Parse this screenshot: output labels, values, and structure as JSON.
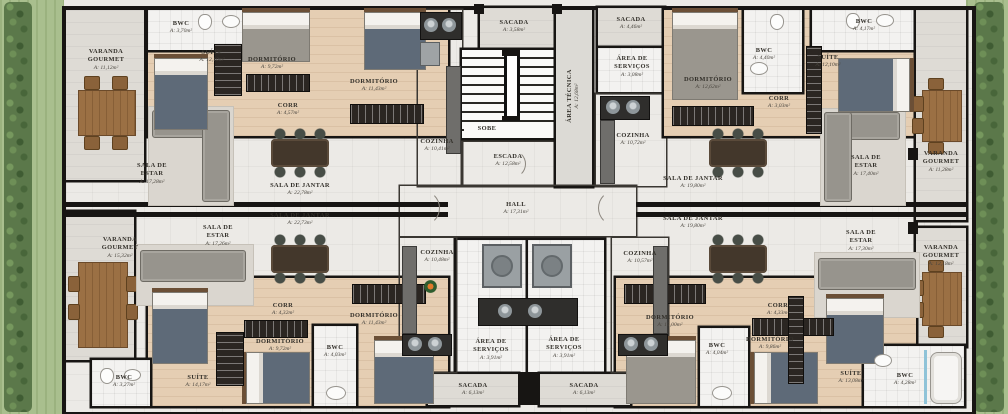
{
  "palette": {
    "wall": "#171513",
    "wood_floor": "#e5ceb3",
    "tile_floor": "#eceae6",
    "balcony_floor": "#dedbd5",
    "grass": "#a9bf8e",
    "hedge": "#5b784a",
    "table_wood": "#9b7044",
    "sofa": "#97948d",
    "blanket": "#5e6a78"
  },
  "labels": {
    "tl_bwc": {
      "name": "BWC",
      "area": "A: 3,70m²"
    },
    "tl_suite": {
      "name": "SUÍTE",
      "area": "A: 12,10m²"
    },
    "tl_dorm1": {
      "name": "DORMITÓRIO",
      "area": "A: 9,72m²"
    },
    "tl_corr": {
      "name": "CORR",
      "area": "A: 4,57m²"
    },
    "tl_dorm2": {
      "name": "DORMITÓRIO",
      "area": "A: 11,43m²"
    },
    "tl_varanda": {
      "name": "VARANDA GOURMET",
      "area": "A: 11,12m²"
    },
    "tl_sala_estar": {
      "name": "SALA DE ESTAR",
      "area": "A: 17,28m²"
    },
    "tl_sala_jantar": {
      "name": "SALA DE JANTAR",
      "area": "A: 22,78m²"
    },
    "tl_cozinha": {
      "name": "COZINHA",
      "area": "A: 10,41m²"
    },
    "c_sacada_top": {
      "name": "SACADA",
      "area": "A: 3,58m²"
    },
    "c_area_tecnica": {
      "name": "ÁREA TÉCNICA",
      "area": "A: 12,68m²"
    },
    "c_sobe": {
      "name": "SOBE",
      "area": ""
    },
    "c_escada": {
      "name": "ESCADA",
      "area": "A: 12,58m²"
    },
    "c_hall": {
      "name": "HALL",
      "area": "A: 17,31m²"
    },
    "tr_sacada": {
      "name": "SACADA",
      "area": "A: 4,46m²"
    },
    "tr_servicos": {
      "name": "ÁREA DE SERVIÇOS",
      "area": "A: 3,08m²"
    },
    "tr_dorm1": {
      "name": "DORMITÓRIO",
      "area": "A: 12,62m²"
    },
    "tr_bwc1": {
      "name": "BWC",
      "area": "A: 4,40m²"
    },
    "tr_corr": {
      "name": "CORR",
      "area": "A: 3,03m²"
    },
    "tr_cozinha": {
      "name": "COZINHA",
      "area": "A: 10,72m²"
    },
    "tr_bwc2": {
      "name": "BWC",
      "area": "A: 4,17m²"
    },
    "tr_suite": {
      "name": "SUÍTE",
      "area": "A: 12,10m²"
    },
    "tr_sala_jantar": {
      "name": "SALA DE JANTAR",
      "area": "A: 19,80m²"
    },
    "tr_sala_estar": {
      "name": "SALA DE ESTAR",
      "area": "A: 17,40m²"
    },
    "tr_varanda": {
      "name": "VARANDA GOURMET",
      "area": "A: 11,28m²"
    },
    "bl_varanda": {
      "name": "VARANDA GOURMET",
      "area": "A: 15,32m²"
    },
    "bl_sala_estar": {
      "name": "SALA DE ESTAR",
      "area": "A: 17,26m²"
    },
    "bl_sala_jantar": {
      "name": "SALA DE JANTAR",
      "area": "A: 22,73m²"
    },
    "bl_cozinha": {
      "name": "COZINHA",
      "area": "A: 10,48m²"
    },
    "bl_corr": {
      "name": "CORR",
      "area": "A: 4,32m²"
    },
    "bl_dorm1": {
      "name": "DORMITÓRIO",
      "area": "A: 9,72m²"
    },
    "bl_dorm2": {
      "name": "DORMITÓRIO",
      "area": "A: 11,43m²"
    },
    "bl_bwc1": {
      "name": "BWC",
      "area": "A: 4,03m²"
    },
    "bl_bwc2": {
      "name": "BWC",
      "area": "A: 3,27m²"
    },
    "bl_suite": {
      "name": "SUÍTE",
      "area": "A: 14,17m²"
    },
    "c_servicos_l": {
      "name": "ÁREA DE SERVIÇOS",
      "area": "A: 3,91m²"
    },
    "c_servicos_r": {
      "name": "ÁREA DE SERVIÇOS",
      "area": "A: 3,91m²"
    },
    "c_sacada_bl": {
      "name": "SACADA",
      "area": "A: 6,13m²"
    },
    "c_sacada_br": {
      "name": "SACADA",
      "area": "A: 6,13m²"
    },
    "br_cozinha": {
      "name": "COZINHA",
      "area": "A: 10,57m²"
    },
    "br_sala_jantar": {
      "name": "SALA DE JANTAR",
      "area": "A: 19,80m²"
    },
    "br_dorm1": {
      "name": "DORMITÓRIO",
      "area": "A: 15,00m²"
    },
    "br_corr": {
      "name": "CORR",
      "area": "A: 4,33m²"
    },
    "br_bwc1": {
      "name": "BWC",
      "area": "A: 4,04m²"
    },
    "br_dorm2": {
      "name": "DORMITÓRIO",
      "area": "A: 9,86m²"
    },
    "br_sala_estar": {
      "name": "SALA DE ESTAR",
      "area": "A: 17,30m²"
    },
    "br_varanda": {
      "name": "VARANDA GOURMET",
      "area": "A: 12,18m²"
    },
    "br_suite": {
      "name": "SUÍTE",
      "area": "A: 13,08m²"
    },
    "br_bwc2": {
      "name": "BWC",
      "area": "A: 4,28m²"
    }
  }
}
